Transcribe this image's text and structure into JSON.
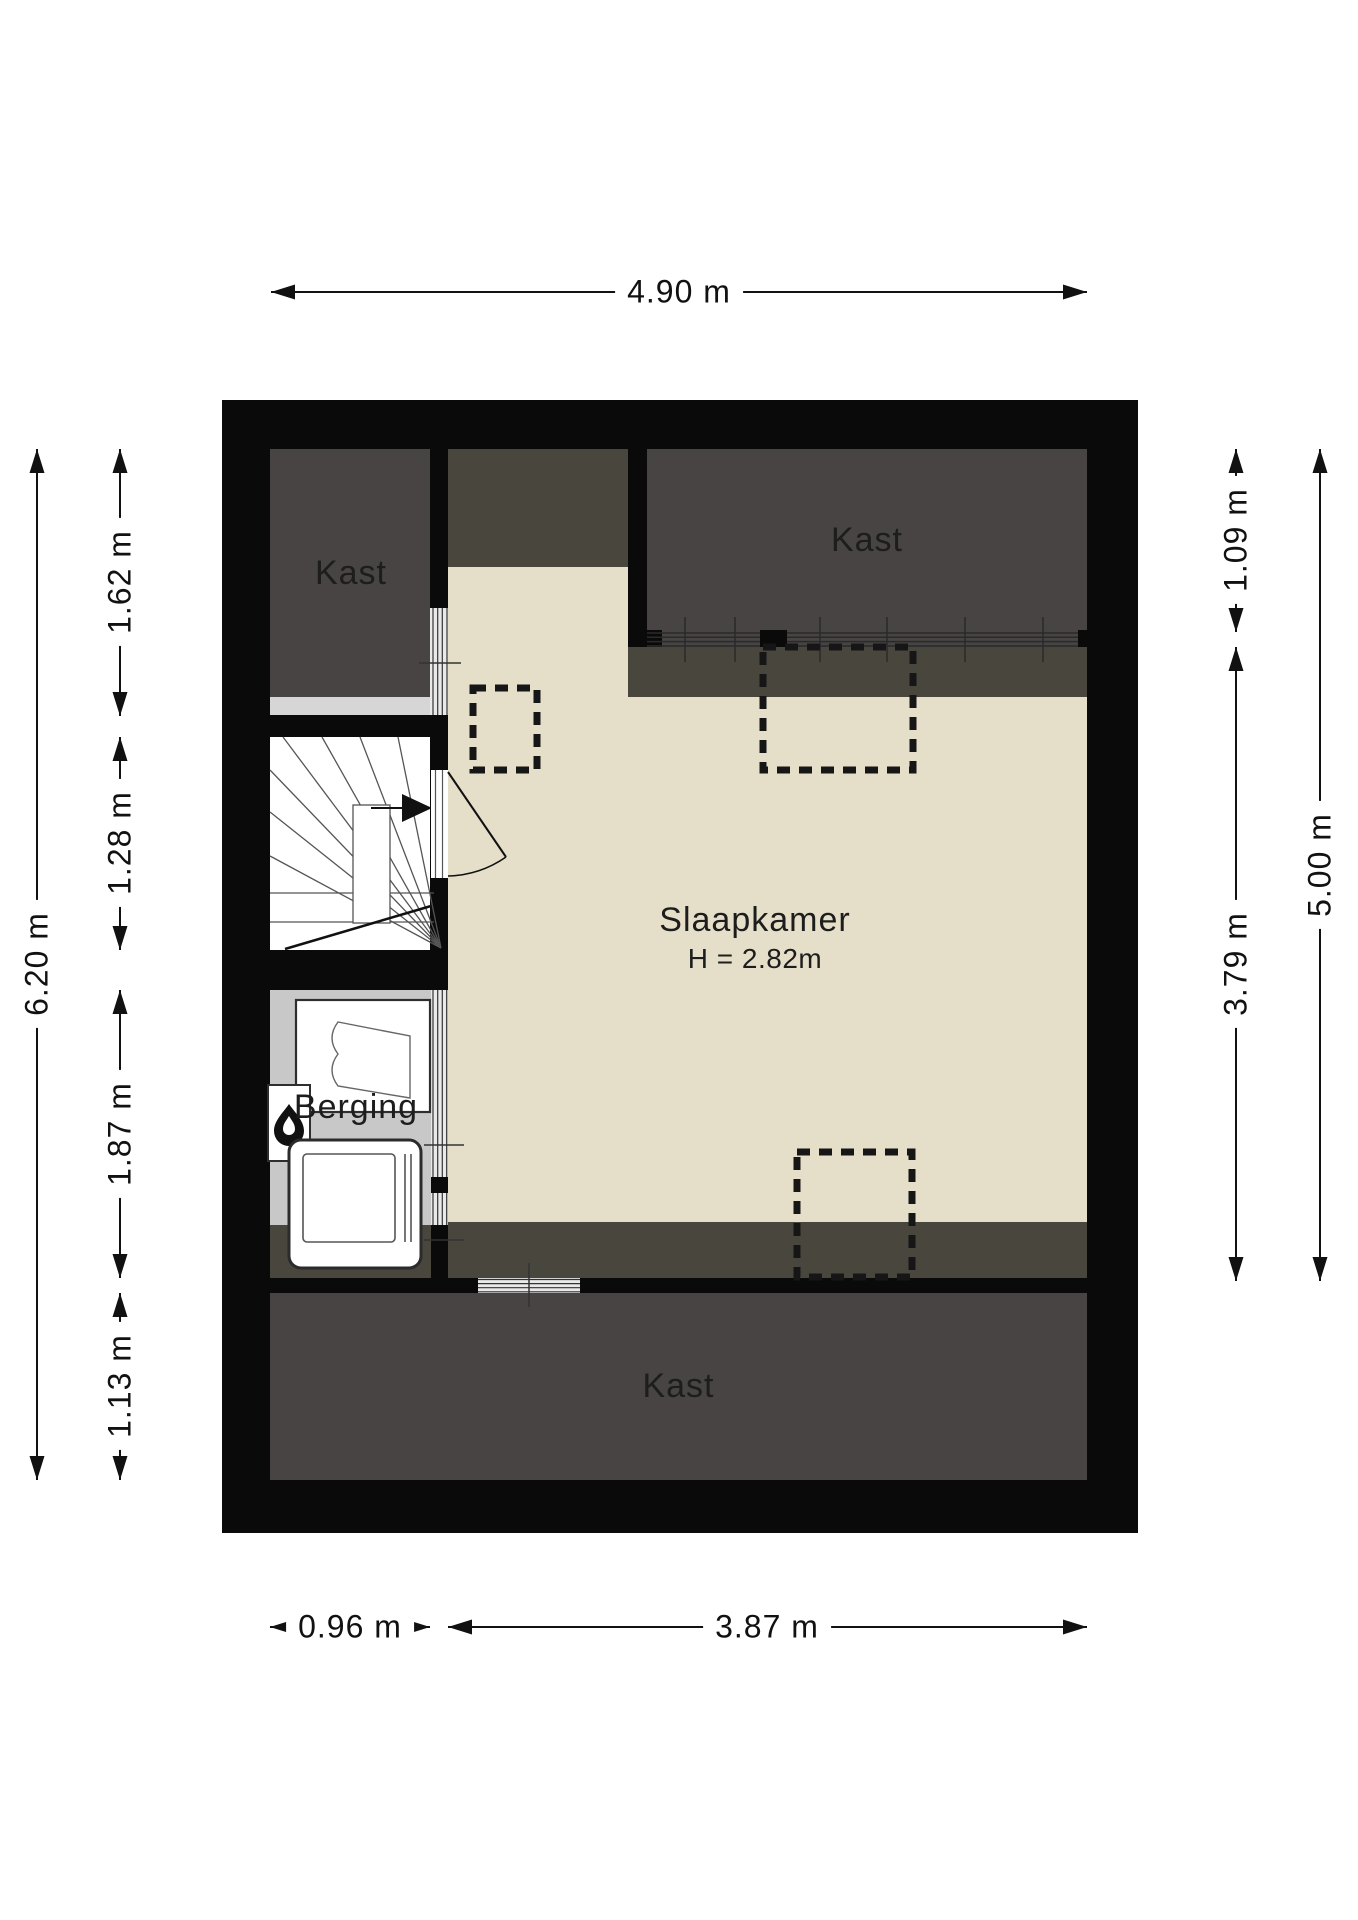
{
  "floorplan": {
    "rooms": {
      "kast_top_left": {
        "label": "Kast"
      },
      "kast_top_right": {
        "label": "Kast"
      },
      "slaapkamer": {
        "label": "Slaapkamer",
        "ceiling_height": "H = 2.82m"
      },
      "berging": {
        "label": "Berging"
      },
      "kast_bottom": {
        "label": "Kast"
      }
    },
    "dimensions": {
      "top_width": "4.90 m",
      "left_total_height": "6.20 m",
      "left_segments": [
        "1.62 m",
        "1.28 m",
        "1.87 m",
        "1.13 m"
      ],
      "right_segments": [
        "1.09 m",
        "3.79 m"
      ],
      "right_total_height": "5.00 m",
      "bottom_segments": [
        "0.96 m",
        "3.87 m"
      ]
    },
    "icons": {
      "stairs_direction": "right-arrow",
      "heater": "flame",
      "skylights": "dashed-rect"
    },
    "colors": {
      "wall": "#0a0a0a",
      "closet_floor": "#474443",
      "sloped_ceiling": "#49463e",
      "bedroom_floor": "#e5dec8",
      "storage_floor": "#c8c8c8",
      "landing_strip": "#d6d6d6",
      "stairs_floor": "#ffffff",
      "dimension_text": "#111111"
    }
  }
}
